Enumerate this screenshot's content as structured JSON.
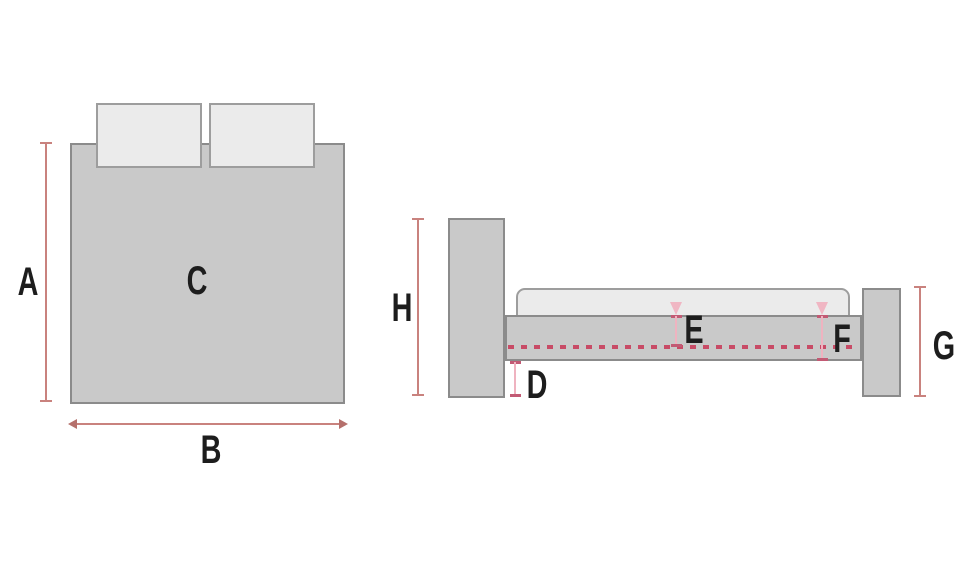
{
  "diagram_title": "bed-dimensions-diagram",
  "colors": {
    "background": "#ffffff",
    "furniture_fill": "#c9c9c9",
    "furniture_border": "#8b8b8b",
    "soft_fill": "#ebebeb",
    "soft_border": "#9d9d9d",
    "dimension_line": "#c9827e",
    "dimension_pink_shaft": "#efb3c0",
    "dimension_pink_end": "#c25a74",
    "slat_dotted_line": "#c84b66",
    "label_text": "#1d1d1d"
  },
  "top_view": {
    "label_length": "A",
    "label_width": "B",
    "label_surface": "C"
  },
  "side_view": {
    "label_headboard_height": "H",
    "label_under_bed_clearance": "D",
    "label_rail_top_to_slats": "E",
    "label_rail_height": "F",
    "label_footboard_height": "G"
  }
}
